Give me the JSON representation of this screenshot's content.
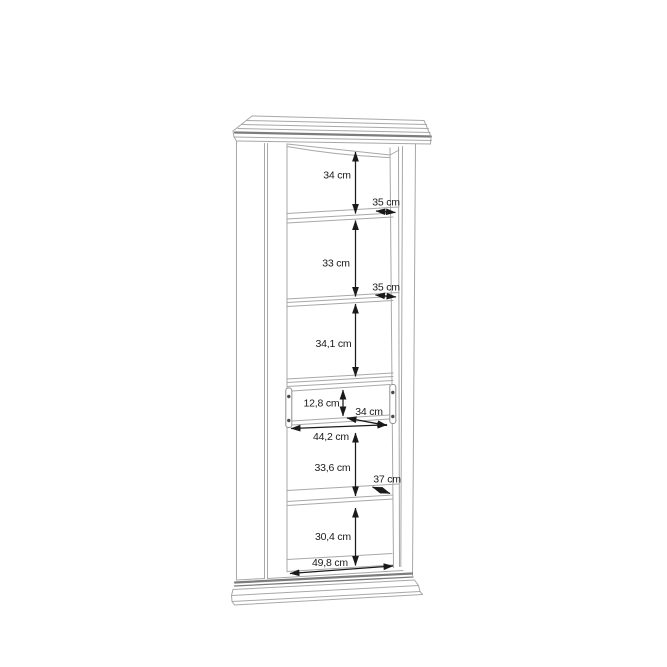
{
  "diagram": {
    "type": "furniture-dimension-drawing",
    "subject": "tall display cabinet with drawer, crown molding and plinth",
    "unit": "cm",
    "colors": {
      "background": "#ffffff",
      "cabinet_line": "#a8a8a8",
      "cabinet_dark_band": "#7c7c7c",
      "dimension": "#1a1a1a"
    },
    "labels": {
      "section1_height": "34 cm",
      "shelf1_depth": "35 cm",
      "section2_height": "33 cm",
      "shelf2_depth": "35 cm",
      "section3_height": "34,1 cm",
      "drawer_inner_height": "12,8 cm",
      "drawer_depth": "34 cm",
      "drawer_width": "44,2 cm",
      "section4_height": "33,6 cm",
      "shelf4_depth": "37 cm",
      "section5_height": "30,4 cm",
      "bottom_width": "49,8 cm"
    }
  }
}
